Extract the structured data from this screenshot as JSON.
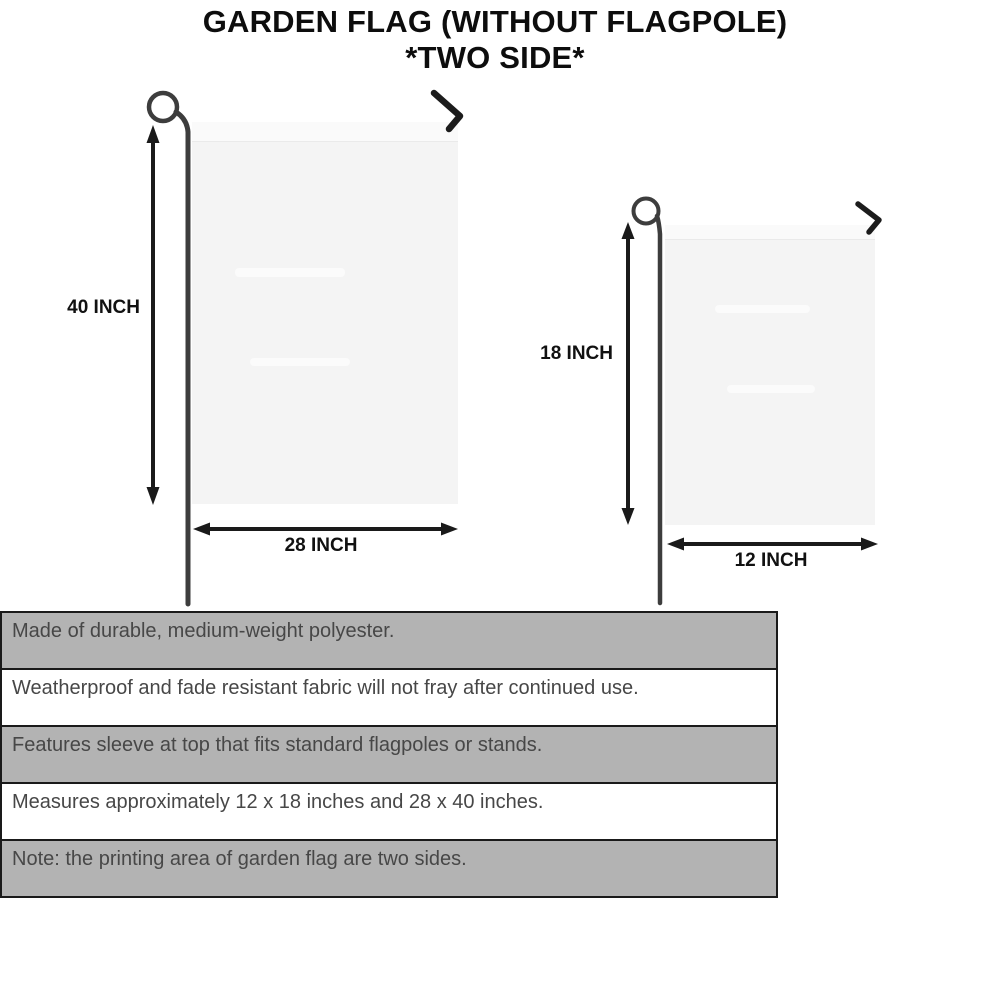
{
  "title": {
    "line1": "GARDEN FLAG (WITHOUT FLAGPOLE)",
    "line2": "*TWO SIDE*"
  },
  "flags": {
    "large": {
      "height_label": "40 INCH",
      "width_label": "28 INCH"
    },
    "small": {
      "height_label": "18 INCH",
      "width_label": "12 INCH"
    }
  },
  "features": [
    "Made of durable, medium-weight polyester.",
    "Weatherproof and fade resistant fabric will not fray after continued use.",
    "Features sleeve at top that fits standard flagpoles or stands.",
    "Measures approximately 12 x 18 inches and 28 x 40 inches.",
    "Note: the printing area of garden flag are two sides."
  ],
  "colors": {
    "background": "#ffffff",
    "flag_fill": "#f4f4f4",
    "pole": "#3d3d3d",
    "hook": "#1c1c1c",
    "arrow": "#1a1a1a",
    "bar_gray": "#b3b3b3",
    "bar_white": "#ffffff",
    "bar_border": "#1a1a1a",
    "bar_text": "#474747",
    "title_text": "#0d0d0d"
  }
}
